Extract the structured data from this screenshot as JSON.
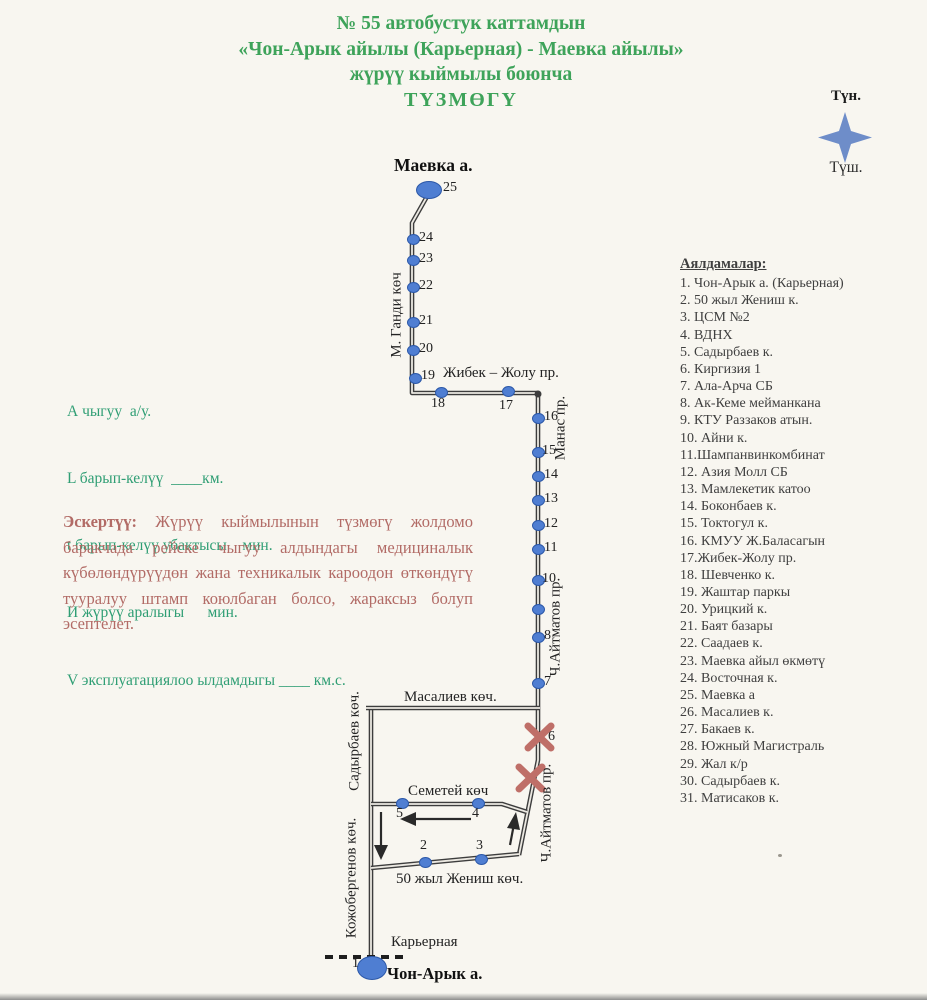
{
  "title": {
    "line1": "№ 55  автобустук каттамдын",
    "line2": "«Чон-Арык айылы (Карьерная) - Маевка айылы»",
    "line3": "жүрүү кыймылы боюнча",
    "line4": "ТҮЗМӨГҮ"
  },
  "compass": {
    "north": "Түн.",
    "south": "Түш."
  },
  "metrics": {
    "line1": "А чыгуу  а/у.",
    "line2": "L барып-келүү  ____км.",
    "line3": "t барып-келүү убактысы    мин.",
    "line4": "И жүрүү аралыгы      мин.",
    "line5": "V эксплуатациялоо ылдамдыгы ____ км.с."
  },
  "note": {
    "label": "Эскертүү:",
    "body": " Жүрүү кыймылынын түзмөгү жолдомо баракчада рейске чыгуу алдындагы медициналык күбөлөндүрүүдөн жана техникалык кароодон өткөндүгү тууралуу штамп коюлбаган болсо, жараксыз болуп эсептелет."
  },
  "stops_list": {
    "header": "Аялдамалар:",
    "items": [
      "1. Чон-Арык а. (Карьерная)",
      "2. 50 жыл Жениш к.",
      "3. ЦСМ №2",
      "4. ВДНХ",
      "5. Садырбаев к.",
      "6. Киргизия 1",
      "7. Ала-Арча СБ",
      "8. Ак-Кеме мейманкана",
      "9. КТУ Раззаков атын.",
      "10. Айни к.",
      "11.Шампанвинкомбинат",
      "12. Азия Молл СБ",
      "13. Мамлекетик катоо",
      "14. Боконбаев к.",
      "15. Токтогул к.",
      "16. КМУУ Ж.Баласагын",
      "17.Жибек-Жолу пр.",
      "18. Шевченко к.",
      "19. Жаштар паркы",
      "20. Урицкий к.",
      "21. Баят базары",
      "22. Саадаев к.",
      "23. Маевка айыл өкмөтү",
      "24. Восточная к.",
      "25. Маевка а",
      "26. Масалиев к.",
      "27. Бакаев к.",
      "28. Южный Магистраль",
      "29. Жал к/р",
      "30. Садырбаев к.",
      "31. Матисаков к."
    ]
  },
  "map": {
    "terminal_top": "Маевка а.",
    "terminal_bottom": "Чон-Арык а.",
    "streets": {
      "m_gandi": "М. Ганди көч",
      "jibek_jolu": "Жибек – Жолу пр.",
      "manas": "Манас пр.",
      "aitmatov_upper": "Ч.Айтматов пр.",
      "aitmatov_lower": "Ч.Айтматов пр.",
      "masaliev": "Масалиев көч.",
      "sadyrbaev": "Садырбаев көч.",
      "semetei": "Семетей көч",
      "kojobergenov": "Кожобергенов көч.",
      "jenish_50": "50 жыл Жениш көч.",
      "karernaya": "Карьерная"
    },
    "stop_numbers": {
      "n1": "1",
      "n2": "2",
      "n3": "3",
      "n4": "4",
      "n5": "5",
      "n6": "6",
      "n7": "7",
      "n8": "8",
      "n10": "10",
      "n11": "11",
      "n12": "12",
      "n13": "13",
      "n14": "14",
      "n15": "15",
      "n16": "16",
      "n17": "17",
      "n18": "18",
      "n19": "19",
      "n20": "20",
      "n21": "21",
      "n22": "22",
      "n23": "23",
      "n24": "24",
      "n25": "25"
    }
  },
  "colors": {
    "title_green": "#3ea35a",
    "metrics_green": "#2f9e74",
    "note_rose": "#b26b66",
    "stop_dot_blue": "#4f7ed2",
    "route_line_dark": "#3d3d3d",
    "closed_stop_x_red": "#bf6f68",
    "compass_blue": "#6e8dc9"
  }
}
